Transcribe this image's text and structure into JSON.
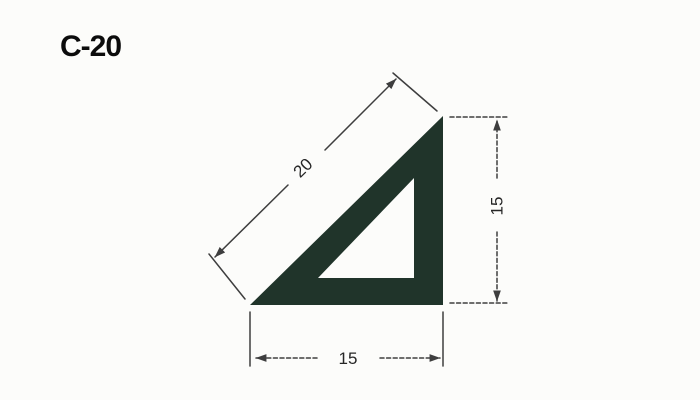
{
  "title": "C-20",
  "drawing": {
    "profile_name": "C-20",
    "dimensions": {
      "hypotenuse": {
        "label": "20",
        "orientation": "diagonal"
      },
      "side": {
        "label": "15",
        "orientation": "vertical"
      },
      "base": {
        "label": "15",
        "orientation": "horizontal"
      }
    },
    "colors": {
      "profile_fill": "#20342a",
      "line": "#3e3e3e",
      "text": "#262626",
      "background": "#fcfcfa"
    }
  }
}
